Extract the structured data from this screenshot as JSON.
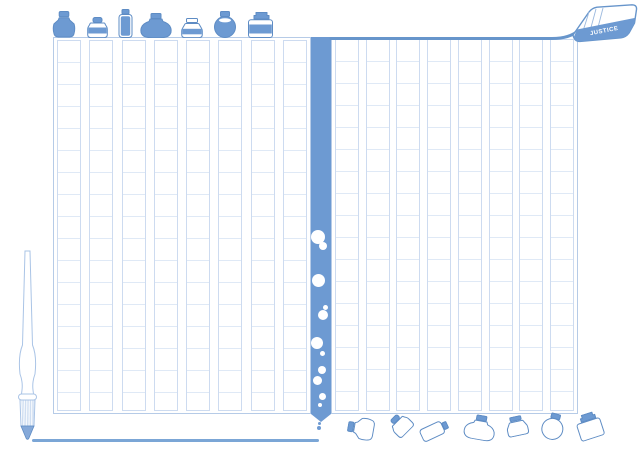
{
  "tag": {
    "label": "JUSTICE"
  },
  "colors": {
    "ink": "#6d9ad2",
    "outline": "#5e8cc4",
    "grid_line": "#dfe9f6",
    "grid_border": "#cddbf0",
    "page_border": "#b6cbe7",
    "page_top_border": "#6795cb",
    "ink_line": "#7ba6d6",
    "pen_outline": "#aac4e6",
    "nib_fill": "#85a9d9",
    "background": "#ffffff"
  },
  "pages": {
    "left": {
      "columns": 8
    },
    "right": {
      "columns": 8
    }
  },
  "ink_stream": {
    "bubbles": [
      {
        "cx": 7,
        "cy": 200,
        "r": 7
      },
      {
        "cx": 11.5,
        "cy": 209,
        "r": 4
      },
      {
        "cx": 7,
        "cy": 243,
        "r": 6.5
      },
      {
        "cx": 14,
        "cy": 270,
        "r": 2.5
      },
      {
        "cx": 11.5,
        "cy": 278,
        "r": 5
      },
      {
        "cx": 6,
        "cy": 306,
        "r": 6
      },
      {
        "cx": 11,
        "cy": 316,
        "r": 2.5
      },
      {
        "cx": 11,
        "cy": 333,
        "r": 4
      },
      {
        "cx": 6,
        "cy": 343,
        "r": 4.5
      },
      {
        "cx": 11,
        "cy": 359,
        "r": 3.5
      },
      {
        "cx": 8.5,
        "cy": 368,
        "r": 2
      }
    ],
    "drips": [
      {
        "x": 319.5,
        "y": 423,
        "d": 3
      },
      {
        "x": 318.8,
        "y": 428,
        "d": 4.5
      }
    ]
  },
  "top_shelf": {
    "bottles": [
      {
        "type": "urn",
        "x": 49,
        "y": 11,
        "w": 30,
        "h": 27
      },
      {
        "type": "small",
        "x": 85,
        "y": 17,
        "w": 25,
        "h": 21
      },
      {
        "type": "vial",
        "x": 117,
        "y": 9,
        "w": 17,
        "h": 29
      },
      {
        "type": "pot",
        "x": 139,
        "y": 13,
        "w": 34,
        "h": 25
      },
      {
        "type": "squat",
        "x": 179,
        "y": 18,
        "w": 26,
        "h": 20
      },
      {
        "type": "round",
        "x": 211,
        "y": 11,
        "w": 28,
        "h": 27
      },
      {
        "type": "square",
        "x": 245,
        "y": 12,
        "w": 31,
        "h": 26
      }
    ]
  },
  "scattered_bottles": [
    {
      "type": "urn",
      "x": 346,
      "y": 415,
      "w": 30,
      "h": 27,
      "rot": -80
    },
    {
      "type": "small",
      "x": 388,
      "y": 414,
      "w": 25,
      "h": 21,
      "rot": -45
    },
    {
      "type": "vial",
      "x": 426,
      "y": 416,
      "w": 17,
      "h": 29,
      "rot": 65
    },
    {
      "type": "pot",
      "x": 463,
      "y": 415,
      "w": 34,
      "h": 25,
      "rot": 10
    },
    {
      "type": "squat",
      "x": 504,
      "y": 416,
      "w": 26,
      "h": 20,
      "rot": -12
    },
    {
      "type": "round",
      "x": 539,
      "y": 413,
      "w": 28,
      "h": 27,
      "rot": 15
    },
    {
      "type": "square",
      "x": 574,
      "y": 413,
      "w": 31,
      "h": 26,
      "rot": -18
    }
  ]
}
